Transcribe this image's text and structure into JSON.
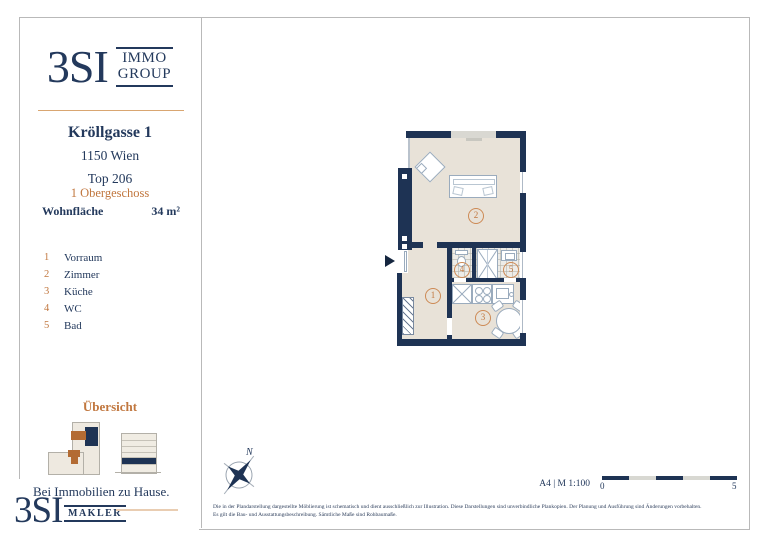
{
  "brand": {
    "logo_text": "3SI",
    "logo_sub1": "IMMO",
    "logo_sub2": "GROUP",
    "slogan": "Bei Immobilien zu Hause.",
    "footer_logo_text": "3SI",
    "footer_logo_sub": "MAKLER"
  },
  "project": {
    "street": "Kröllgasse 1",
    "city": "1150 Wien",
    "unit": "Top 206",
    "floor": "1 Obergeschoss",
    "area_label": "Wohnfläche",
    "area_value": "34 m²"
  },
  "rooms": [
    {
      "num": "1",
      "name": "Vorraum"
    },
    {
      "num": "2",
      "name": "Zimmer"
    },
    {
      "num": "3",
      "name": "Küche"
    },
    {
      "num": "4",
      "name": "WC"
    },
    {
      "num": "5",
      "name": "Bad"
    }
  ],
  "overview": {
    "title": "Übersicht"
  },
  "plan": {
    "numbers": {
      "vorraum": "1",
      "zimmer": "2",
      "kueche": "3",
      "wc": "4",
      "bad": "5"
    },
    "compass_label": "N"
  },
  "footer": {
    "format_scale": "A4 | M 1:100",
    "scalebar_start": "0",
    "scalebar_end": "5",
    "disclaimer_line1": "Die in der Plandarstellung dargestellte Möblierung ist schematisch und dient ausschließlich zur Illustration. Diese Darstellungen sind unverbindliche Plankopien. Der Planung und Ausführung sind Änderungen vorbehalten.",
    "disclaimer_line2": "Es gilt die Bau- und Ausstattungsbeschreibung. Sämtliche Maße sind Rohbaumaße."
  },
  "colors": {
    "navy": "#23395C",
    "wall_navy": "#1E3354",
    "accent_orange": "#C1773F",
    "floor_beige": "#E8E2D8",
    "tile_gray": "#EDECE8",
    "frame_gray": "#B9B9B9"
  }
}
